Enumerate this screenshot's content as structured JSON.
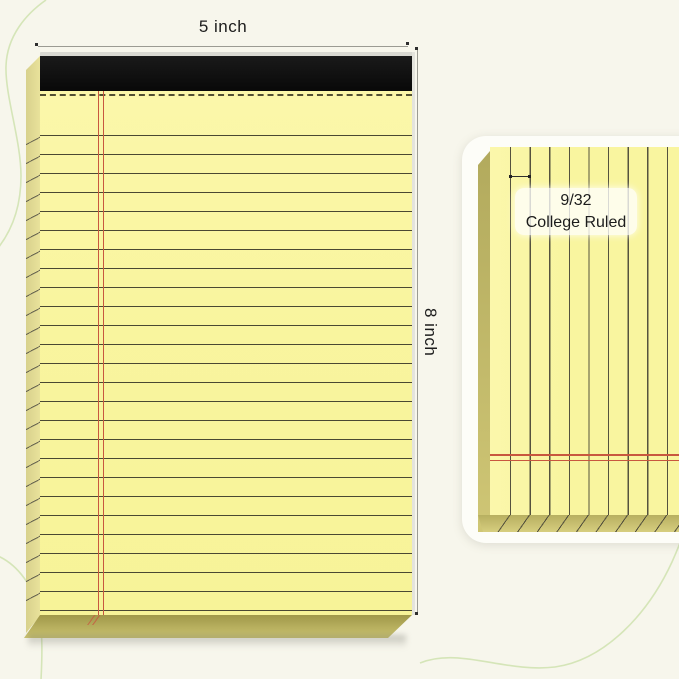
{
  "annotations": {
    "width_label": "5 inch",
    "height_label": "8 inch"
  },
  "detail_card": {
    "ruling_fraction": "9/32",
    "ruling_name": "College Ruled"
  },
  "notepad": {
    "binding": "black top binding strip",
    "perforation": "dashed perforation line",
    "margin": "double red margin line",
    "rule_spacing_label": "9/32"
  },
  "colors": {
    "background": "#f7f6ec",
    "decor_line": "#cfe2af",
    "paper": "#f9f59f",
    "paper_edge": "#e9e29b",
    "paper_bevel": "#b3aa5c",
    "binding": "#0e0e0e",
    "rule_line": "#4a4832",
    "margin_line": "#c8573f",
    "dimension_line": "#9b9b93",
    "text": "#1c1c1c",
    "card_background": "#fdfdf8"
  }
}
